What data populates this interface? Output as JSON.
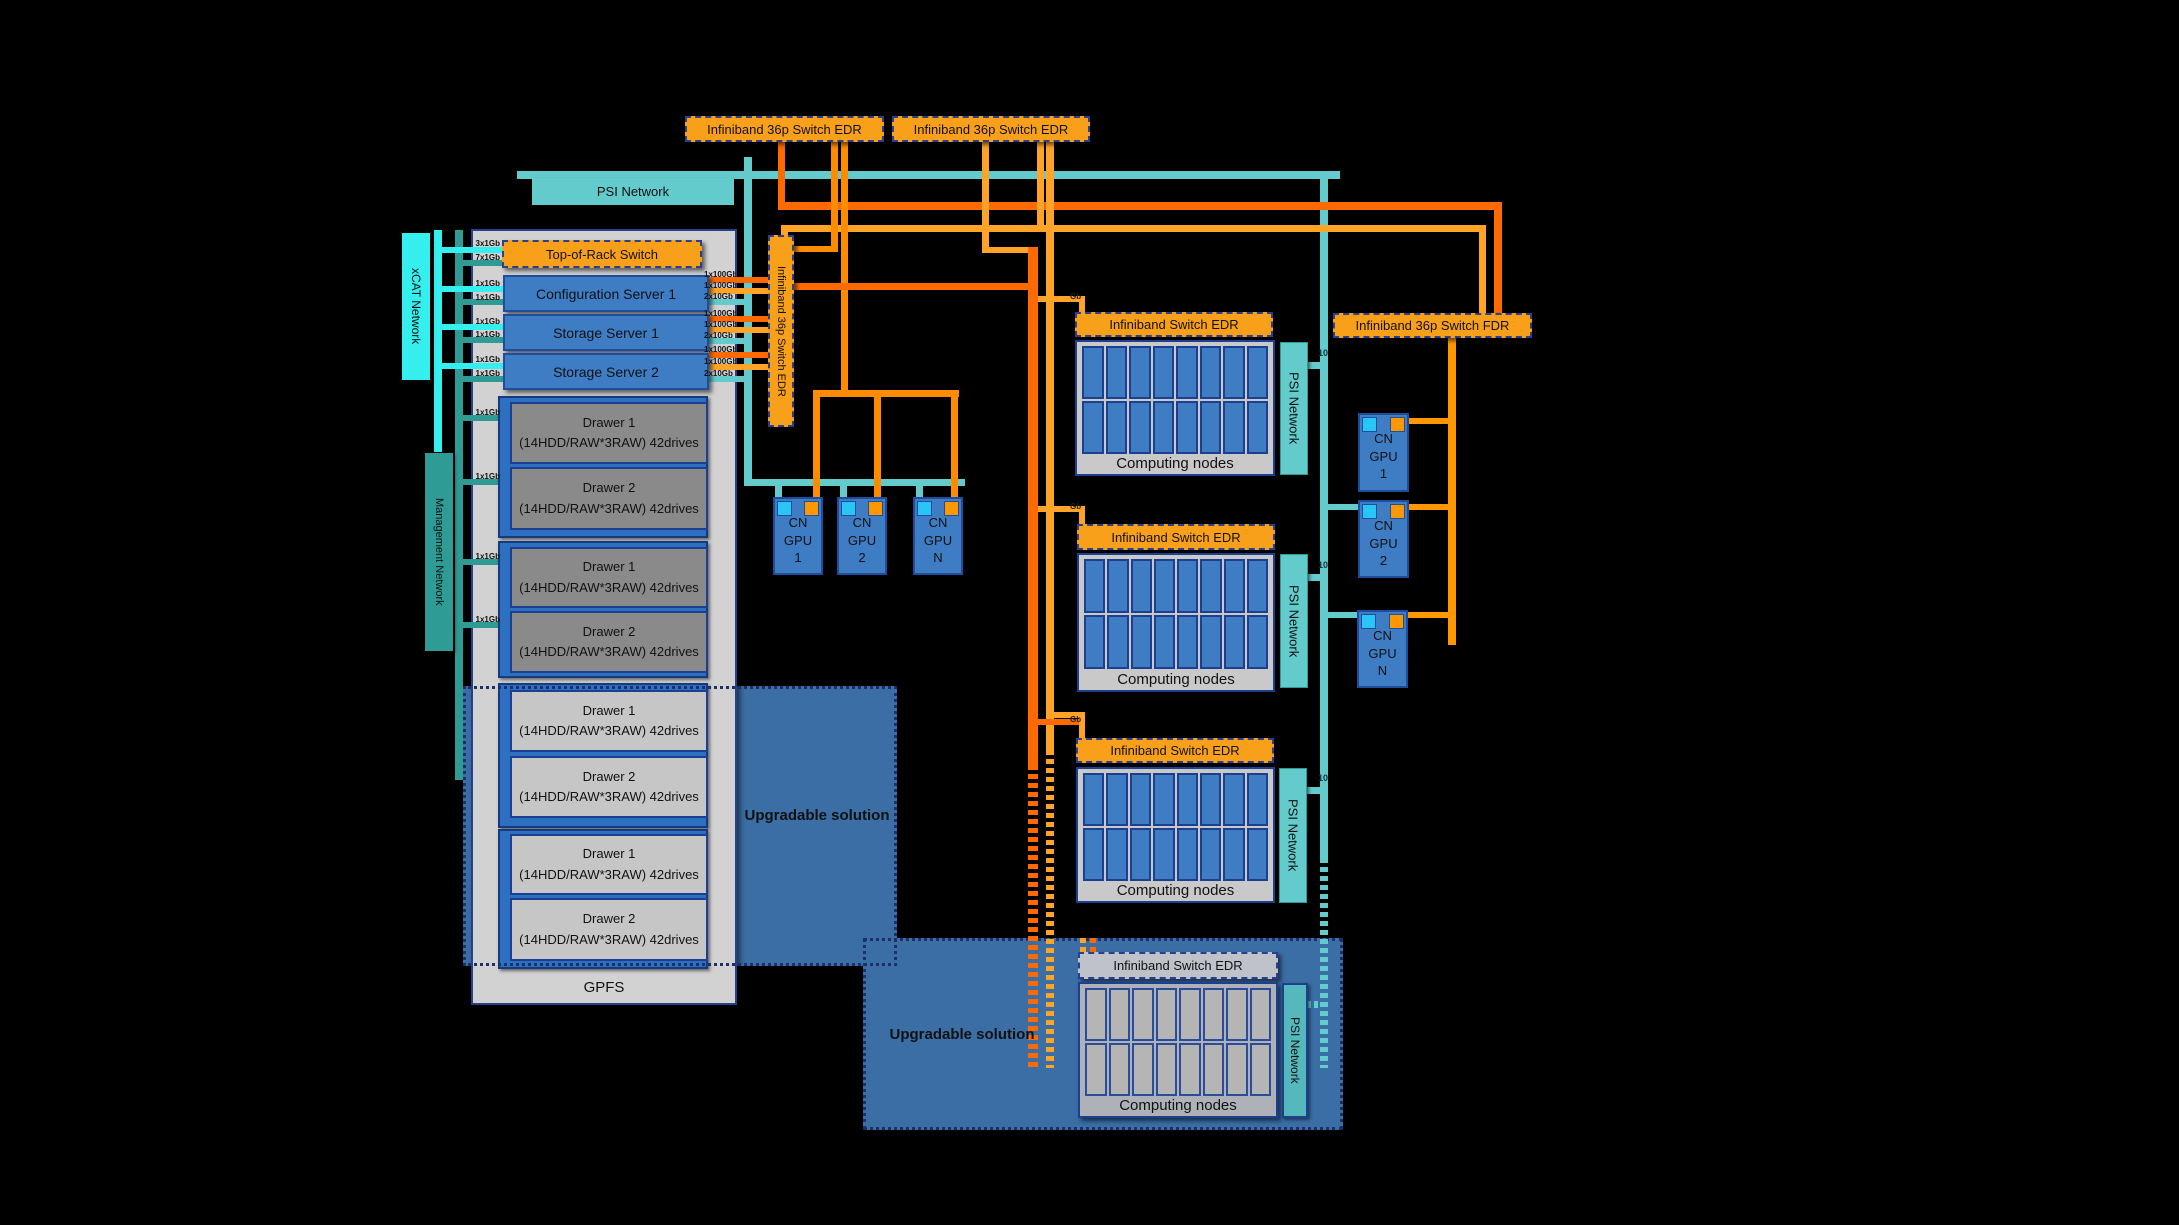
{
  "labels": {
    "top_switch": "Infiniband 36p Switch EDR",
    "psi_network": "PSI Network",
    "xcat_network": "xCAT Network",
    "management_network": "Management Network",
    "vertical_switch": "Infiniband 36p Switch EDR",
    "fdr_switch": "Infiniband 36p Switch FDR",
    "top_of_rack": "Top-of-Rack Switch",
    "gpfs": "GPFS",
    "upgradable": "Upgradable solution",
    "block_header": "Infiniband Switch EDR",
    "computing_nodes": "Computing nodes"
  },
  "servers": [
    "Configuration Server 1",
    "Storage Server 1",
    "Storage Server 2"
  ],
  "drawers": {
    "d1": "Drawer 1",
    "d2": "Drawer 2",
    "spec": "(14HDD/RAW*3RAW) 42drives"
  },
  "gpu": {
    "cn": "CN",
    "gpu": "GPU",
    "n1": "1",
    "n2": "2",
    "nn": "N"
  },
  "ports": {
    "p3x1": "3x1Gb",
    "p7x1": "7x1Gb",
    "p1x1": "1x1Gb",
    "p1x100": "1x100Gb",
    "p2x10": "2x10Gb"
  },
  "misc": {
    "ten": "10",
    "gb": "Gb"
  },
  "colors": {
    "switch_orange": "#F9A01B",
    "dark_orange_link": "#FF6A00",
    "light_orange_link": "#FFA428",
    "psi_teal": "#63CBCB",
    "management_teal": "#2E9C94",
    "xcat_cyan": "#35EFEF",
    "node_blue": "#3E7CC4",
    "upgradable_blue": "#3A6EA5",
    "border_navy": "#1D3F8F"
  }
}
